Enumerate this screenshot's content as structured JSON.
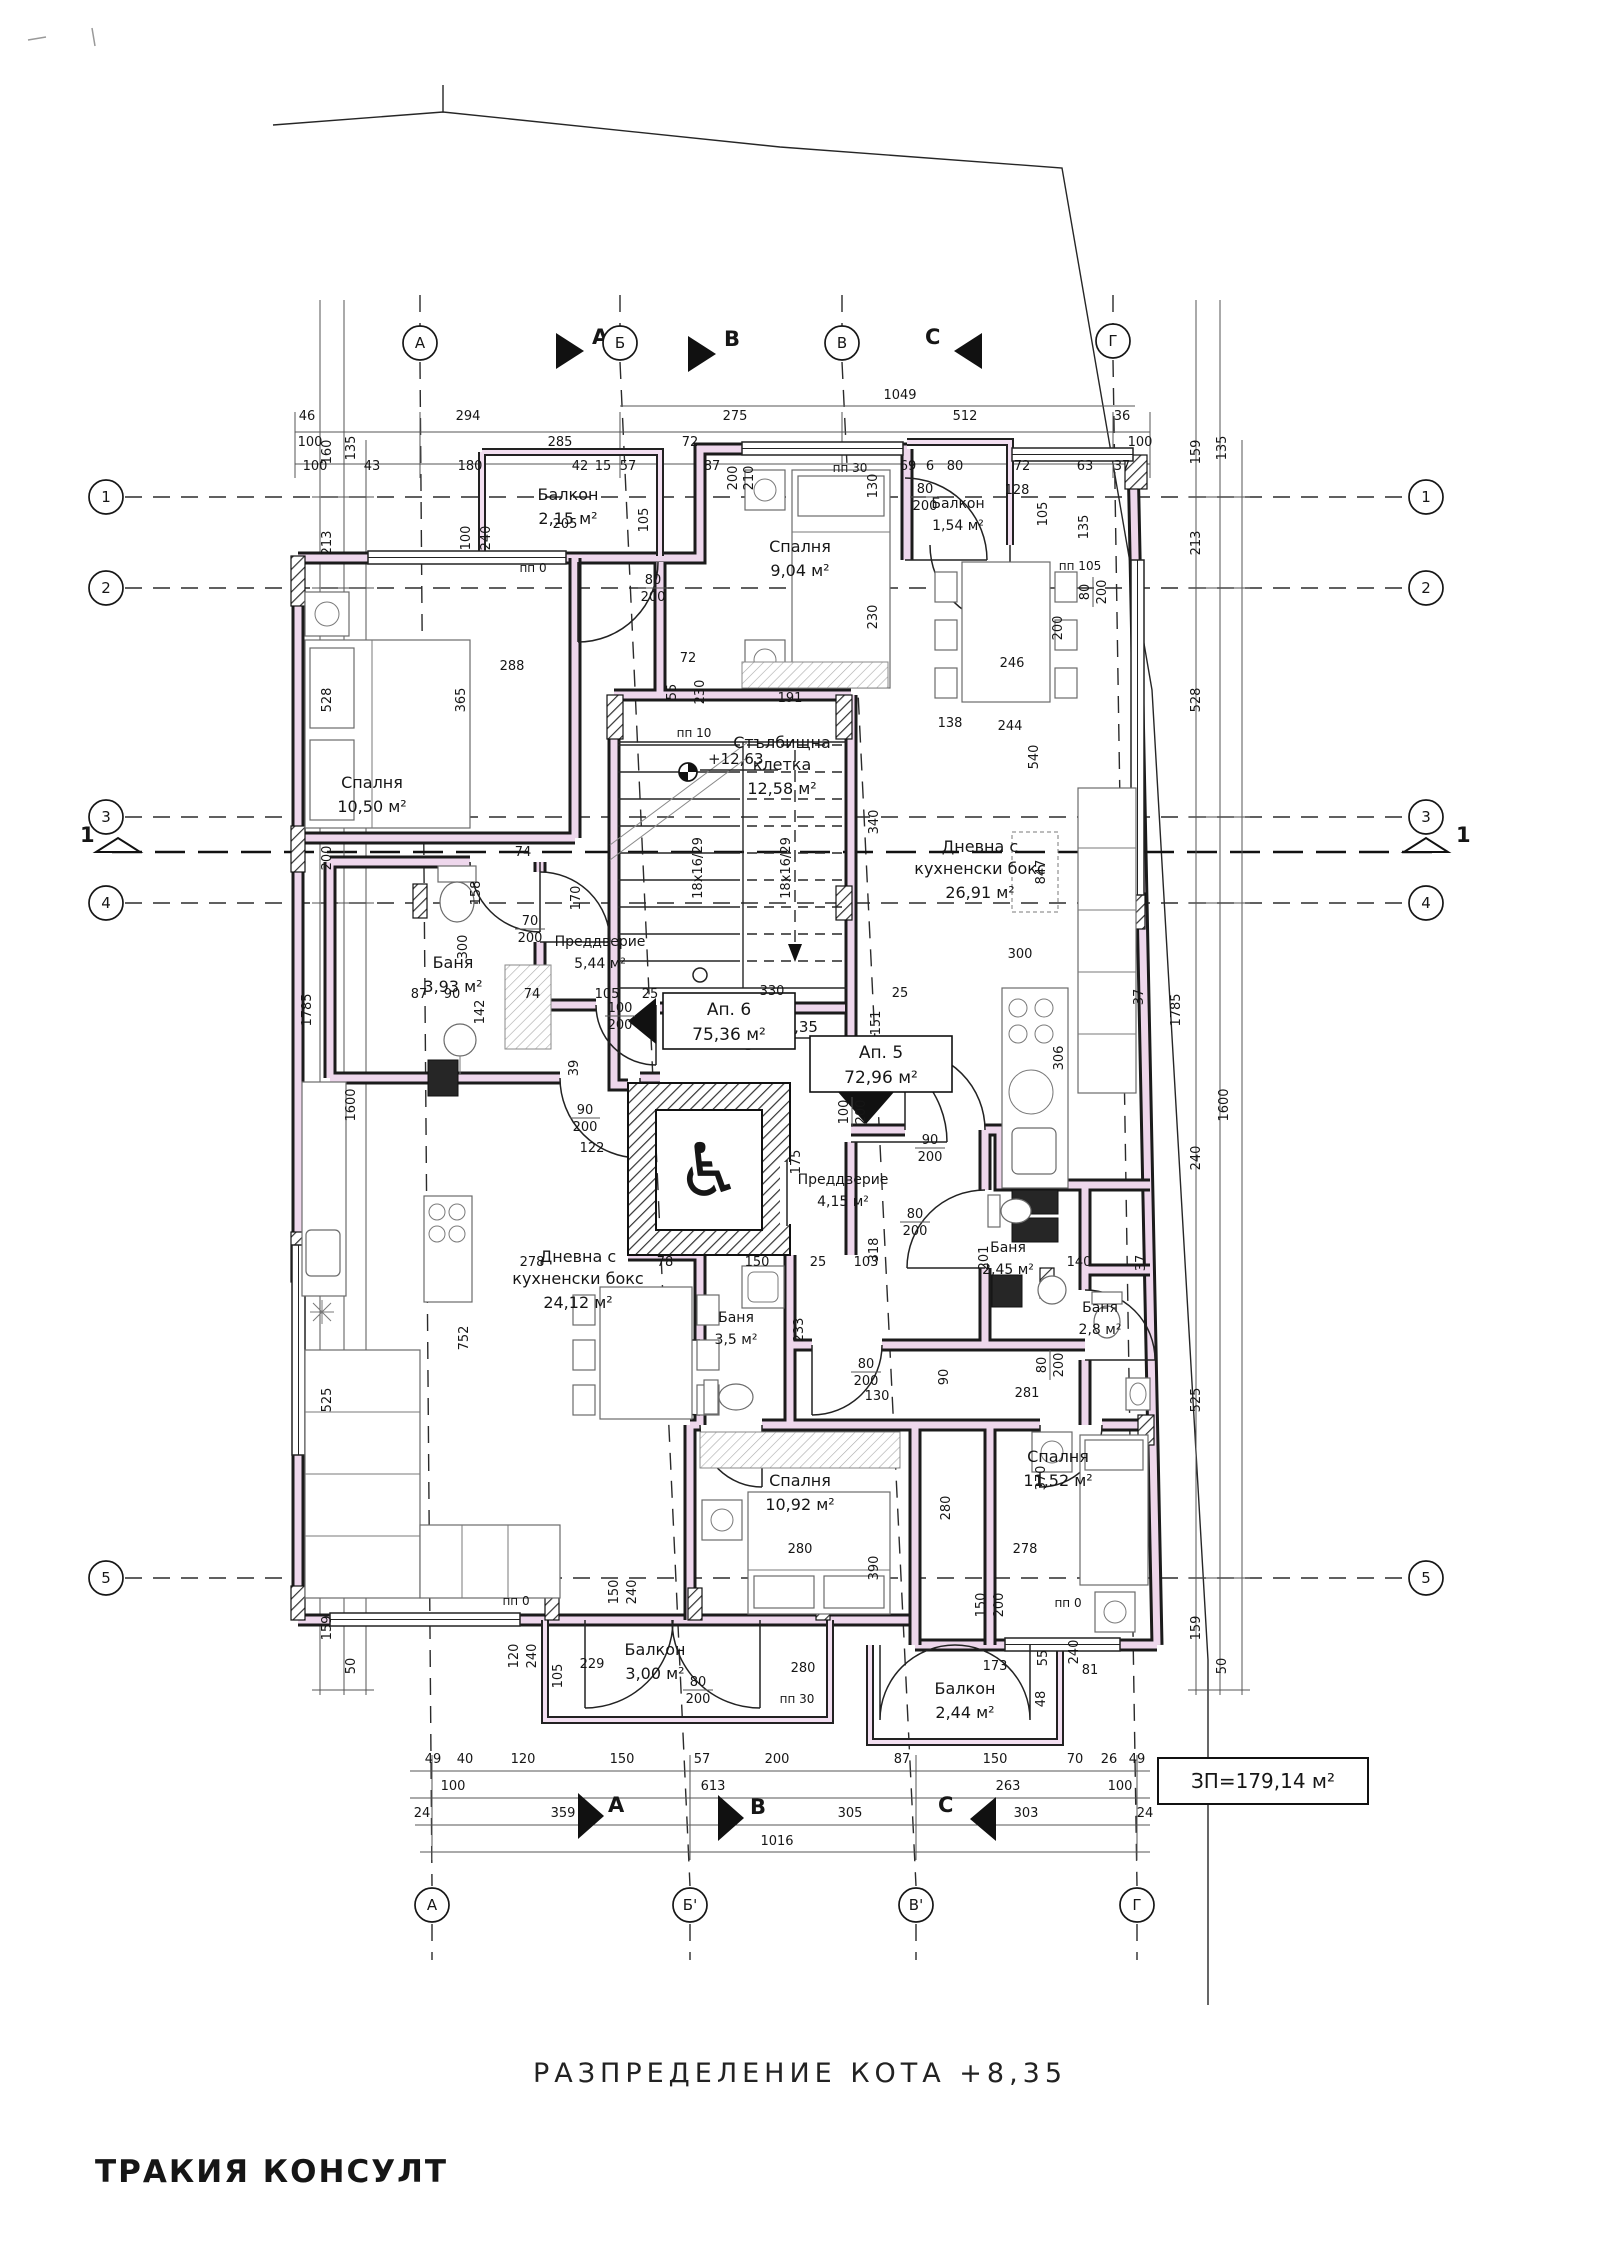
{
  "title": {
    "text": "РАЗПРЕДЕЛЕНИЕ КОТА +8,35"
  },
  "branding": {
    "company": "ТРАКИЯ КОНСУЛТ",
    "color": "#c4807b"
  },
  "badge": {
    "text": "ЗП=179,14 м²"
  },
  "level_marks": {
    "floor": "+8,35",
    "stair": "+12,63"
  },
  "icons": {
    "wheelchair": "♿"
  },
  "sections": {
    "a": "A",
    "b": "B",
    "c": "C",
    "cut": "1"
  },
  "apartments": [
    {
      "label": "Ап. 6",
      "area": "75,36 м²"
    },
    {
      "label": "Ап. 5",
      "area": "72,96 м²"
    }
  ],
  "rooms": [
    {
      "lines": [
        "Балкон",
        "2,15 м²"
      ]
    },
    {
      "lines": [
        "Спалня",
        "10,50 м²"
      ]
    },
    {
      "lines": [
        "Спалня",
        "9,04 м²"
      ]
    },
    {
      "lines": [
        "Балкон",
        "1,54 м²"
      ]
    },
    {
      "lines": [
        "Стълбищна",
        "клетка",
        "12,58 м²"
      ]
    },
    {
      "lines": [
        "Дневна с",
        "кухненски бокс",
        "26,91 м²"
      ]
    },
    {
      "lines": [
        "Баня",
        "3,93 м²"
      ]
    },
    {
      "lines": [
        "Преддверие",
        "5,44 м²"
      ]
    },
    {
      "lines": [
        "Преддверие",
        "4,15 м²"
      ]
    },
    {
      "lines": [
        "Дневна с",
        "кухненски бокс",
        "24,12 м²"
      ]
    },
    {
      "lines": [
        "Баня",
        "3,5 м²"
      ]
    },
    {
      "lines": [
        "Баня",
        "2,45 м²"
      ]
    },
    {
      "lines": [
        "Баня",
        "2,8 м²"
      ]
    },
    {
      "lines": [
        "Спалня",
        "10,92 м²"
      ]
    },
    {
      "lines": [
        "Спалня",
        "11,52 м²"
      ]
    },
    {
      "lines": [
        "Балкон",
        "3,00 м²"
      ]
    },
    {
      "lines": [
        "Балкон",
        "2,44 м²"
      ]
    }
  ],
  "axes": {
    "top": [
      {
        "label": "А",
        "x": 420,
        "y": 343
      },
      {
        "label": "Б",
        "x": 620,
        "y": 343
      },
      {
        "label": "В",
        "x": 842,
        "y": 343
      },
      {
        "label": "Г",
        "x": 1113,
        "y": 341
      }
    ],
    "bottom": [
      {
        "label": "А",
        "x": 432,
        "y": 1905
      },
      {
        "label": "Б'",
        "x": 690,
        "y": 1905
      },
      {
        "label": "В'",
        "x": 916,
        "y": 1905
      },
      {
        "label": "Г",
        "x": 1137,
        "y": 1905
      }
    ],
    "left": [
      {
        "label": "1",
        "x": 106,
        "y": 497
      },
      {
        "label": "2",
        "x": 106,
        "y": 588
      },
      {
        "label": "3",
        "x": 106,
        "y": 817
      },
      {
        "label": "4",
        "x": 106,
        "y": 903
      },
      {
        "label": "5",
        "x": 106,
        "y": 1578
      }
    ],
    "right": [
      {
        "label": "1",
        "x": 1426,
        "y": 497
      },
      {
        "label": "2",
        "x": 1426,
        "y": 588
      },
      {
        "label": "3",
        "x": 1426,
        "y": 817
      },
      {
        "label": "4",
        "x": 1426,
        "y": 903
      },
      {
        "label": "5",
        "x": 1426,
        "y": 1578
      }
    ]
  },
  "stair_note": "18x16/29",
  "dim_labels": [
    {
      "t": "46",
      "x": 307,
      "y": 420
    },
    {
      "t": "294",
      "x": 468,
      "y": 420
    },
    {
      "t": "275",
      "x": 735,
      "y": 420
    },
    {
      "t": "512",
      "x": 965,
      "y": 420
    },
    {
      "t": "36",
      "x": 1122,
      "y": 420
    },
    {
      "t": "1049",
      "x": 900,
      "y": 399
    },
    {
      "t": "100",
      "x": 310,
      "y": 446
    },
    {
      "t": "285",
      "x": 560,
      "y": 446
    },
    {
      "t": "72",
      "x": 690,
      "y": 446
    },
    {
      "t": "100",
      "x": 1140,
      "y": 446
    },
    {
      "t": "100",
      "x": 315,
      "y": 470
    },
    {
      "t": "43",
      "x": 372,
      "y": 470
    },
    {
      "t": "180",
      "x": 470,
      "y": 470
    },
    {
      "t": "42",
      "x": 580,
      "y": 470
    },
    {
      "t": "15",
      "x": 603,
      "y": 470
    },
    {
      "t": "57",
      "x": 628,
      "y": 470
    },
    {
      "t": "87",
      "x": 712,
      "y": 470
    },
    {
      "t": "69",
      "x": 908,
      "y": 470
    },
    {
      "t": "6",
      "x": 930,
      "y": 470
    },
    {
      "t": "80",
      "x": 955,
      "y": 470
    },
    {
      "t": "72",
      "x": 1022,
      "y": 470
    },
    {
      "t": "63",
      "x": 1085,
      "y": 470
    },
    {
      "t": "37",
      "x": 1122,
      "y": 470
    },
    {
      "t": "200",
      "x": 737,
      "y": 478,
      "r": -90
    },
    {
      "t": "210",
      "x": 753,
      "y": 478,
      "r": -90
    },
    {
      "t": "49",
      "x": 433,
      "y": 1763
    },
    {
      "t": "40",
      "x": 465,
      "y": 1763
    },
    {
      "t": "120",
      "x": 523,
      "y": 1763
    },
    {
      "t": "150",
      "x": 622,
      "y": 1763
    },
    {
      "t": "57",
      "x": 702,
      "y": 1763
    },
    {
      "t": "200",
      "x": 777,
      "y": 1763
    },
    {
      "t": "87",
      "x": 902,
      "y": 1763
    },
    {
      "t": "150",
      "x": 995,
      "y": 1763
    },
    {
      "t": "70",
      "x": 1075,
      "y": 1763
    },
    {
      "t": "26",
      "x": 1109,
      "y": 1763
    },
    {
      "t": "49",
      "x": 1137,
      "y": 1763
    },
    {
      "t": "100",
      "x": 453,
      "y": 1790
    },
    {
      "t": "613",
      "x": 713,
      "y": 1790
    },
    {
      "t": "263",
      "x": 1008,
      "y": 1790
    },
    {
      "t": "100",
      "x": 1120,
      "y": 1790
    },
    {
      "t": "24",
      "x": 422,
      "y": 1817
    },
    {
      "t": "359",
      "x": 563,
      "y": 1817
    },
    {
      "t": "305",
      "x": 850,
      "y": 1817
    },
    {
      "t": "303",
      "x": 1026,
      "y": 1817
    },
    {
      "t": "24",
      "x": 1145,
      "y": 1817
    },
    {
      "t": "1016",
      "x": 777,
      "y": 1845
    },
    {
      "t": "160",
      "x": 331,
      "y": 452,
      "r": -90
    },
    {
      "t": "135",
      "x": 355,
      "y": 448,
      "r": -90
    },
    {
      "t": "213",
      "x": 331,
      "y": 543,
      "r": -90
    },
    {
      "t": "528",
      "x": 331,
      "y": 700,
      "r": -90
    },
    {
      "t": "1785",
      "x": 311,
      "y": 1010,
      "r": -90
    },
    {
      "t": "1600",
      "x": 355,
      "y": 1105,
      "r": -90
    },
    {
      "t": "200",
      "x": 331,
      "y": 858,
      "r": -90
    },
    {
      "t": "525",
      "x": 331,
      "y": 1400,
      "r": -90
    },
    {
      "t": "159",
      "x": 331,
      "y": 1628,
      "r": -90
    },
    {
      "t": "50",
      "x": 355,
      "y": 1666,
      "r": -90
    },
    {
      "t": "159",
      "x": 1200,
      "y": 452,
      "r": -90
    },
    {
      "t": "135",
      "x": 1226,
      "y": 448,
      "r": -90
    },
    {
      "t": "213",
      "x": 1200,
      "y": 543,
      "r": -90
    },
    {
      "t": "528",
      "x": 1200,
      "y": 700,
      "r": -90
    },
    {
      "t": "1785",
      "x": 1180,
      "y": 1010,
      "r": -90
    },
    {
      "t": "1600",
      "x": 1228,
      "y": 1105,
      "r": -90
    },
    {
      "t": "240",
      "x": 1200,
      "y": 1158,
      "r": -90
    },
    {
      "t": "525",
      "x": 1200,
      "y": 1400,
      "r": -90
    },
    {
      "t": "159",
      "x": 1200,
      "y": 1628,
      "r": -90
    },
    {
      "t": "50",
      "x": 1226,
      "y": 1666,
      "r": -90
    },
    {
      "t": "205",
      "x": 565,
      "y": 528
    },
    {
      "t": "105",
      "x": 648,
      "y": 520,
      "r": -90
    },
    {
      "t": "100",
      "x": 470,
      "y": 538,
      "r": -90
    },
    {
      "t": "240",
      "x": 490,
      "y": 538,
      "r": -90
    },
    {
      "t": "288",
      "x": 512,
      "y": 670
    },
    {
      "t": "365",
      "x": 465,
      "y": 700,
      "r": -90
    },
    {
      "t": "72",
      "x": 688,
      "y": 662
    },
    {
      "t": "55",
      "x": 676,
      "y": 692,
      "r": -90
    },
    {
      "t": "230",
      "x": 704,
      "y": 692,
      "r": -90
    },
    {
      "t": "пп 0",
      "x": 533,
      "y": 572,
      "s": 1
    },
    {
      "t": "пп 10",
      "x": 694,
      "y": 737,
      "s": 1
    },
    {
      "t": "пп 30",
      "x": 850,
      "y": 472,
      "s": 1
    },
    {
      "t": "пп 105",
      "x": 1080,
      "y": 570,
      "s": 1
    },
    {
      "t": "пп 0",
      "x": 516,
      "y": 1605,
      "s": 1
    },
    {
      "t": "пп 30",
      "x": 797,
      "y": 1703,
      "s": 1
    },
    {
      "t": "пп 0",
      "x": 1068,
      "y": 1607,
      "s": 1
    },
    {
      "t": "130",
      "x": 877,
      "y": 486,
      "r": -90
    },
    {
      "t": "230",
      "x": 877,
      "y": 617,
      "r": -90
    },
    {
      "t": "191",
      "x": 790,
      "y": 702
    },
    {
      "t": "128",
      "x": 1017,
      "y": 494
    },
    {
      "t": "105",
      "x": 1047,
      "y": 514,
      "r": -90
    },
    {
      "t": "135",
      "x": 1088,
      "y": 527,
      "r": -90
    },
    {
      "t": "138",
      "x": 950,
      "y": 727
    },
    {
      "t": "340",
      "x": 878,
      "y": 822,
      "r": -90
    },
    {
      "t": "300",
      "x": 1020,
      "y": 958
    },
    {
      "t": "306",
      "x": 1063,
      "y": 1058,
      "r": -90
    },
    {
      "t": "330",
      "x": 772,
      "y": 995
    },
    {
      "t": "87",
      "x": 419,
      "y": 998
    },
    {
      "t": "90",
      "x": 452,
      "y": 998
    },
    {
      "t": "74",
      "x": 532,
      "y": 998
    },
    {
      "t": "105",
      "x": 607,
      "y": 998
    },
    {
      "t": "25",
      "x": 650,
      "y": 998
    },
    {
      "t": "25",
      "x": 900,
      "y": 997
    },
    {
      "t": "74",
      "x": 523,
      "y": 856
    },
    {
      "t": "158",
      "x": 480,
      "y": 893,
      "r": -90
    },
    {
      "t": "170",
      "x": 580,
      "y": 898,
      "r": -90
    },
    {
      "t": "300",
      "x": 467,
      "y": 947,
      "r": -90
    },
    {
      "t": "142",
      "x": 484,
      "y": 1012,
      "r": -90
    },
    {
      "t": "39",
      "x": 578,
      "y": 1068,
      "r": -90
    },
    {
      "t": "122",
      "x": 592,
      "y": 1152
    },
    {
      "t": "151",
      "x": 880,
      "y": 1023,
      "r": -90
    },
    {
      "t": "175",
      "x": 800,
      "y": 1162,
      "r": -90
    },
    {
      "t": "100/200",
      "x": 620,
      "y": 1016,
      "f": 1
    },
    {
      "t": "90/200",
      "x": 585,
      "y": 1118,
      "f": 1
    },
    {
      "t": "100/200",
      "x": 852,
      "y": 1112,
      "f": 1,
      "r": -90
    },
    {
      "t": "90/200",
      "x": 930,
      "y": 1148,
      "f": 1
    },
    {
      "t": "80/200",
      "x": 915,
      "y": 1222,
      "f": 1
    },
    {
      "t": "80/200",
      "x": 866,
      "y": 1372,
      "f": 1
    },
    {
      "t": "80/200",
      "x": 1050,
      "y": 1365,
      "f": 1,
      "r": -90
    },
    {
      "t": "80/200",
      "x": 653,
      "y": 588,
      "f": 1
    },
    {
      "t": "80/200",
      "x": 925,
      "y": 497,
      "f": 1
    },
    {
      "t": "80/200",
      "x": 1093,
      "y": 592,
      "f": 1,
      "r": -90
    },
    {
      "t": "70/200",
      "x": 530,
      "y": 929,
      "f": 1
    },
    {
      "t": "80/200",
      "x": 698,
      "y": 1690,
      "f": 1
    },
    {
      "t": "278",
      "x": 532,
      "y": 1266
    },
    {
      "t": "78",
      "x": 665,
      "y": 1266
    },
    {
      "t": "150",
      "x": 757,
      "y": 1266
    },
    {
      "t": "25",
      "x": 818,
      "y": 1266
    },
    {
      "t": "103",
      "x": 866,
      "y": 1266
    },
    {
      "t": "140",
      "x": 1079,
      "y": 1266
    },
    {
      "t": "318",
      "x": 878,
      "y": 1250,
      "r": -90
    },
    {
      "t": "201",
      "x": 988,
      "y": 1258,
      "r": -90
    },
    {
      "t": "233",
      "x": 803,
      "y": 1330,
      "r": -90
    },
    {
      "t": "90",
      "x": 948,
      "y": 1377,
      "r": -90
    },
    {
      "t": "130",
      "x": 877,
      "y": 1400
    },
    {
      "t": "281",
      "x": 1027,
      "y": 1397
    },
    {
      "t": "752",
      "x": 468,
      "y": 1338,
      "r": -90
    },
    {
      "t": "847",
      "x": 1045,
      "y": 872,
      "r": -90
    },
    {
      "t": "200",
      "x": 1062,
      "y": 628,
      "r": -90
    },
    {
      "t": "246",
      "x": 1012,
      "y": 667
    },
    {
      "t": "244",
      "x": 1010,
      "y": 730
    },
    {
      "t": "540",
      "x": 1038,
      "y": 757,
      "r": -90
    },
    {
      "t": "280",
      "x": 950,
      "y": 1508,
      "r": -90
    },
    {
      "t": "390",
      "x": 878,
      "y": 1568,
      "r": -90
    },
    {
      "t": "280",
      "x": 800,
      "y": 1553
    },
    {
      "t": "280",
      "x": 803,
      "y": 1672
    },
    {
      "t": "278",
      "x": 1025,
      "y": 1553
    },
    {
      "t": "370",
      "x": 1045,
      "y": 1478,
      "r": -90
    },
    {
      "t": "173",
      "x": 995,
      "y": 1670
    },
    {
      "t": "55",
      "x": 1047,
      "y": 1658,
      "r": -90
    },
    {
      "t": "240",
      "x": 1078,
      "y": 1652,
      "r": -90
    },
    {
      "t": "48",
      "x": 1045,
      "y": 1699,
      "r": -90
    },
    {
      "t": "81",
      "x": 1090,
      "y": 1674
    },
    {
      "t": "229",
      "x": 592,
      "y": 1668
    },
    {
      "t": "105",
      "x": 562,
      "y": 1676,
      "r": -90
    },
    {
      "t": "120",
      "x": 518,
      "y": 1656,
      "r": -90
    },
    {
      "t": "240",
      "x": 536,
      "y": 1656,
      "r": -90
    },
    {
      "t": "150",
      "x": 618,
      "y": 1592,
      "r": -90
    },
    {
      "t": "240",
      "x": 636,
      "y": 1592,
      "r": -90
    },
    {
      "t": "150",
      "x": 985,
      "y": 1605,
      "r": -90
    },
    {
      "t": "200",
      "x": 1003,
      "y": 1605,
      "r": -90
    },
    {
      "t": "37",
      "x": 1143,
      "y": 997,
      "r": -90
    },
    {
      "t": "37",
      "x": 1145,
      "y": 1263,
      "r": -90
    },
    {
      "t": "18x16/29",
      "x": 702,
      "y": 868,
      "r": -90
    },
    {
      "t": "18x16/29",
      "x": 790,
      "y": 868,
      "r": -90
    }
  ]
}
